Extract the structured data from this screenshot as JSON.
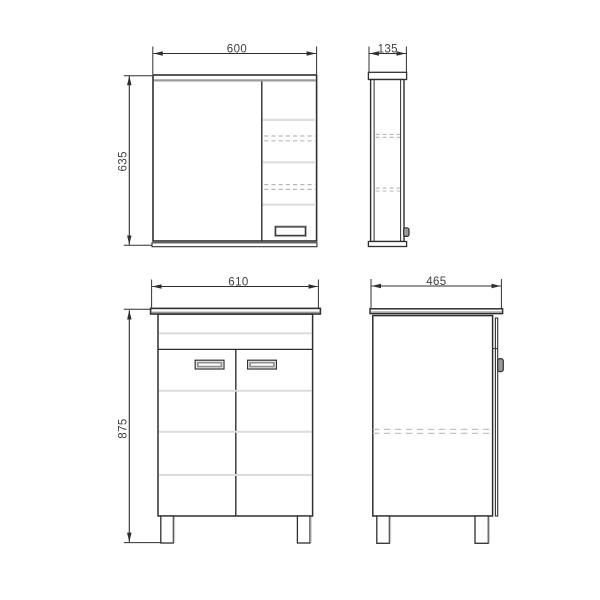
{
  "dimensions": {
    "mirror_cabinet": {
      "width": "600",
      "height": "635",
      "depth": "135"
    },
    "base_cabinet": {
      "width": "610",
      "height": "875",
      "depth": "465"
    }
  }
}
